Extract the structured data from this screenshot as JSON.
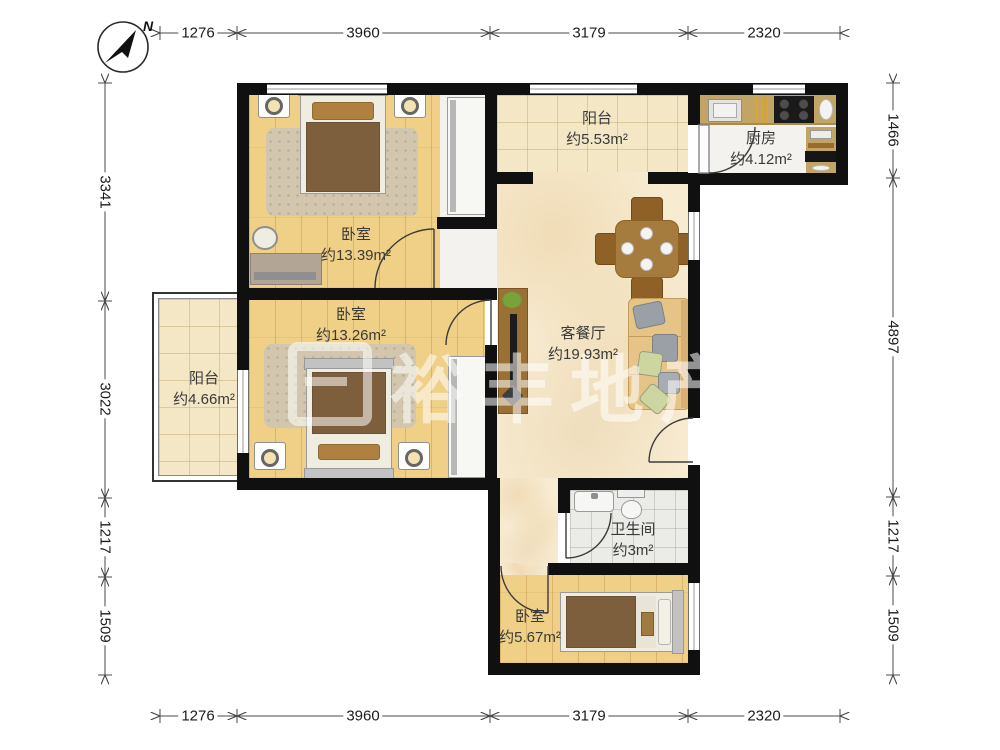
{
  "compass": {
    "north_label": "N"
  },
  "watermark": {
    "text": "裕丰地产"
  },
  "dimensions": {
    "top": [
      "1276",
      "3960",
      "3179",
      "2320"
    ],
    "bottom": [
      "1276",
      "3960",
      "3179",
      "2320"
    ],
    "left": [
      "3341",
      "3022",
      "1217",
      "1509"
    ],
    "right": [
      "1466",
      "4897",
      "1217",
      "1509"
    ]
  },
  "rooms": {
    "balcony_top": {
      "name": "阳台",
      "area": "约5.53m²"
    },
    "kitchen": {
      "name": "厨房",
      "area": "约4.12m²"
    },
    "bedroom_top": {
      "name": "卧室",
      "area": "约13.39m²"
    },
    "bedroom_mid": {
      "name": "卧室",
      "area": "约13.26m²"
    },
    "balcony_left": {
      "name": "阳台",
      "area": "约4.66m²"
    },
    "living": {
      "name": "客餐厅",
      "area": "约19.93m²"
    },
    "bathroom": {
      "name": "卫生间",
      "area": "约3m²"
    },
    "bedroom_small": {
      "name": "卧室",
      "area": "约5.67m²"
    }
  },
  "colors": {
    "wall": "#101010",
    "wood_floor": "#f0cf86",
    "marble_floor": "#f7ebd1",
    "balcony_tile": "#f3e7c5",
    "kitchen_counter": "#c2a566",
    "sofa": "#e6c386",
    "table": "#a57c3e",
    "blanket": "#7d5f3e"
  }
}
